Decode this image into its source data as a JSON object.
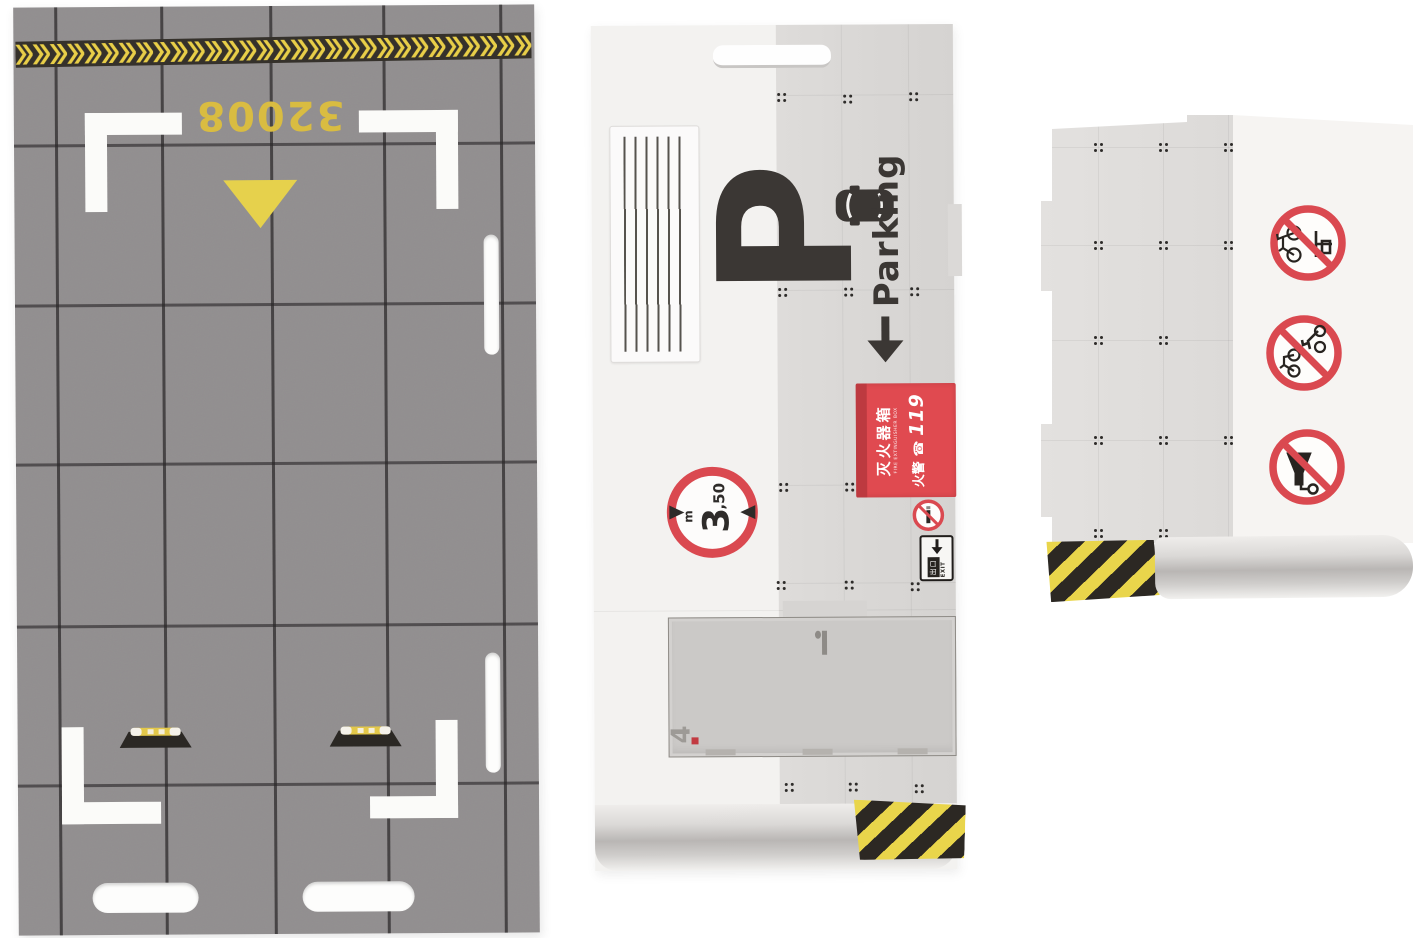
{
  "scene": {
    "description": "Cardboard model-kit pieces for a toy parking garage laid on white background",
    "background_color": "#ffffff"
  },
  "floor_piece": {
    "lot_number": "32008",
    "icons": [
      "chevron-hazard-strip",
      "direction-triangle",
      "corner-brackets",
      "wheel-stops",
      "slot-cutouts"
    ],
    "colors": {
      "asphalt": "#918e8f",
      "grid_line": "#2a2728",
      "marking_white": "#fbfbf9",
      "marking_yellow": "#d9bc41",
      "chevron_yellow": "#e8ce48",
      "chevron_black": "#35312b"
    }
  },
  "parking_wall_piece": {
    "p_letter": "P",
    "parking_label": "Parking",
    "arrow_icon": "arrow-down",
    "extinguisher_sign": {
      "title": "灭火器箱",
      "subtitle": "FIRE EXTINGUISHER BOX",
      "alarm_label": "火警",
      "phone_icon": "☎",
      "alarm_number": "119",
      "bg_color": "#e04a50"
    },
    "height_limit_sign": {
      "big": "3",
      "small": ",50",
      "unit": "m"
    },
    "no_smoking_sign": {
      "name": "no-smoking"
    },
    "exit_sign": {
      "cn": "出口",
      "en": "EXIT"
    },
    "door_number": "4",
    "icons": [
      "vent-grille",
      "car-top-view",
      "slot-cutout",
      "hazard-stripe",
      "door-panel"
    ]
  },
  "signs_wall_piece": {
    "prohibition_signs": [
      "no-bicycles",
      "no-motorcycles",
      "no-horn"
    ],
    "ring_color": "#da4950",
    "icons": [
      "hazard-stripe",
      "perforation-dots",
      "assembly-tabs"
    ]
  },
  "palette": {
    "hazard_yellow": "#e9d54b",
    "hazard_black": "#2c2823",
    "sign_red": "#da4950",
    "ink_dark": "#3b3734",
    "card_white": "#f3f2f0",
    "card_gray": "#dad8d6"
  }
}
